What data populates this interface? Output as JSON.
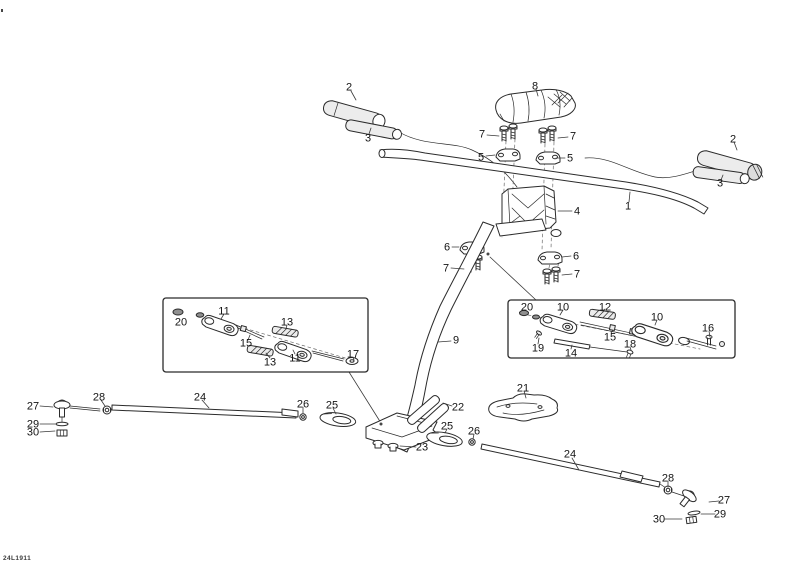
{
  "doc_code": "24L1911",
  "colors": {
    "line": "#2b2b2b",
    "background": "#ffffff",
    "label": "#141414"
  },
  "diagram_type": "exploded-parts-diagram",
  "callouts": [
    {
      "t": "2",
      "x": 349,
      "y": 87,
      "l": [
        351,
        91,
        356,
        100
      ]
    },
    {
      "t": "3",
      "x": 368,
      "y": 138,
      "l": [
        369,
        134,
        371,
        128
      ]
    },
    {
      "t": "8",
      "x": 535,
      "y": 86,
      "l": [
        536,
        89,
        538,
        96
      ]
    },
    {
      "t": "7",
      "x": 482,
      "y": 134,
      "l": [
        487,
        135,
        499,
        136
      ]
    },
    {
      "t": "5",
      "x": 481,
      "y": 157,
      "l": [
        486,
        156,
        495,
        155
      ]
    },
    {
      "t": "7",
      "x": 573,
      "y": 136,
      "l": [
        568,
        137,
        558,
        138
      ]
    },
    {
      "t": "5",
      "x": 570,
      "y": 158,
      "l": [
        565,
        158,
        556,
        158
      ]
    },
    {
      "t": "2",
      "x": 733,
      "y": 139,
      "l": [
        734,
        142,
        737,
        150
      ]
    },
    {
      "t": "3",
      "x": 720,
      "y": 183,
      "l": [
        721,
        180,
        723,
        175
      ]
    },
    {
      "t": "1",
      "x": 628,
      "y": 206,
      "l": [
        629,
        202,
        630,
        192
      ]
    },
    {
      "t": "4",
      "x": 577,
      "y": 211,
      "l": [
        572,
        211,
        558,
        211
      ]
    },
    {
      "t": "6",
      "x": 447,
      "y": 247,
      "l": [
        452,
        247,
        459,
        247
      ]
    },
    {
      "t": "7",
      "x": 446,
      "y": 268,
      "l": [
        451,
        268,
        464,
        269
      ]
    },
    {
      "t": "6",
      "x": 576,
      "y": 256,
      "l": [
        571,
        256,
        562,
        257
      ]
    },
    {
      "t": "7",
      "x": 577,
      "y": 274,
      "l": [
        572,
        274,
        562,
        275
      ]
    },
    {
      "t": "9",
      "x": 456,
      "y": 340,
      "l": [
        451,
        341,
        438,
        342
      ]
    },
    {
      "t": "20",
      "x": 181,
      "y": 322
    },
    {
      "t": "11",
      "x": 224,
      "y": 311,
      "l": [
        224,
        314,
        221,
        319
      ]
    },
    {
      "t": "13",
      "x": 287,
      "y": 322,
      "l": [
        287,
        325,
        286,
        329
      ]
    },
    {
      "t": "15",
      "x": 246,
      "y": 343,
      "l": [
        248,
        340,
        250,
        335
      ]
    },
    {
      "t": "13",
      "x": 270,
      "y": 362,
      "l": [
        270,
        358,
        266,
        353
      ]
    },
    {
      "t": "11",
      "x": 295,
      "y": 358,
      "l": [
        295,
        354,
        293,
        350
      ]
    },
    {
      "t": "17",
      "x": 353,
      "y": 354,
      "l": [
        353,
        357,
        354,
        360
      ]
    },
    {
      "t": "20",
      "x": 527,
      "y": 307
    },
    {
      "t": "10",
      "x": 563,
      "y": 307,
      "l": [
        563,
        310,
        560,
        315
      ]
    },
    {
      "t": "12",
      "x": 605,
      "y": 307,
      "l": [
        605,
        309,
        603,
        312
      ]
    },
    {
      "t": "10",
      "x": 657,
      "y": 317,
      "l": [
        657,
        320,
        655,
        325
      ]
    },
    {
      "t": "16",
      "x": 708,
      "y": 328,
      "l": [
        709,
        331,
        710,
        337
      ]
    },
    {
      "t": "15",
      "x": 610,
      "y": 337,
      "l": [
        611,
        333,
        613,
        330
      ]
    },
    {
      "t": "18",
      "x": 630,
      "y": 344,
      "l": [
        630,
        347,
        631,
        350
      ]
    },
    {
      "t": "19",
      "x": 538,
      "y": 348,
      "l": [
        538,
        344,
        539,
        338
      ]
    },
    {
      "t": "14",
      "x": 571,
      "y": 353,
      "l": [
        571,
        349,
        572,
        345
      ]
    },
    {
      "t": "27",
      "x": 33,
      "y": 406,
      "l": [
        40,
        406,
        53,
        407
      ]
    },
    {
      "t": "28",
      "x": 99,
      "y": 397,
      "l": [
        101,
        400,
        105,
        406
      ]
    },
    {
      "t": "24",
      "x": 200,
      "y": 397,
      "l": [
        202,
        400,
        209,
        408
      ]
    },
    {
      "t": "29",
      "x": 33,
      "y": 424,
      "l": [
        40,
        424,
        55,
        424
      ]
    },
    {
      "t": "30",
      "x": 33,
      "y": 432,
      "l": [
        40,
        432,
        55,
        431
      ]
    },
    {
      "t": "26",
      "x": 303,
      "y": 404,
      "l": [
        303,
        407,
        303,
        413
      ]
    },
    {
      "t": "25",
      "x": 332,
      "y": 405,
      "l": [
        333,
        408,
        336,
        414
      ]
    },
    {
      "t": "22",
      "x": 458,
      "y": 407,
      "l": [
        452,
        406,
        443,
        403
      ]
    },
    {
      "t": "21",
      "x": 523,
      "y": 388,
      "l": [
        524,
        391,
        526,
        398
      ]
    },
    {
      "t": "23",
      "x": 422,
      "y": 447,
      "l": [
        416,
        447,
        400,
        446
      ]
    },
    {
      "t": "25",
      "x": 447,
      "y": 426,
      "l": [
        447,
        429,
        445,
        433
      ]
    },
    {
      "t": "26",
      "x": 474,
      "y": 431,
      "l": [
        474,
        434,
        473,
        439
      ]
    },
    {
      "t": "24",
      "x": 570,
      "y": 454,
      "l": [
        572,
        458,
        579,
        470
      ]
    },
    {
      "t": "28",
      "x": 668,
      "y": 478,
      "l": [
        668,
        481,
        668,
        487
      ]
    },
    {
      "t": "27",
      "x": 724,
      "y": 500,
      "l": [
        719,
        501,
        709,
        502
      ]
    },
    {
      "t": "29",
      "x": 720,
      "y": 514,
      "l": [
        715,
        514,
        701,
        514
      ]
    },
    {
      "t": "30",
      "x": 659,
      "y": 519,
      "l": [
        665,
        519,
        682,
        519
      ]
    }
  ]
}
